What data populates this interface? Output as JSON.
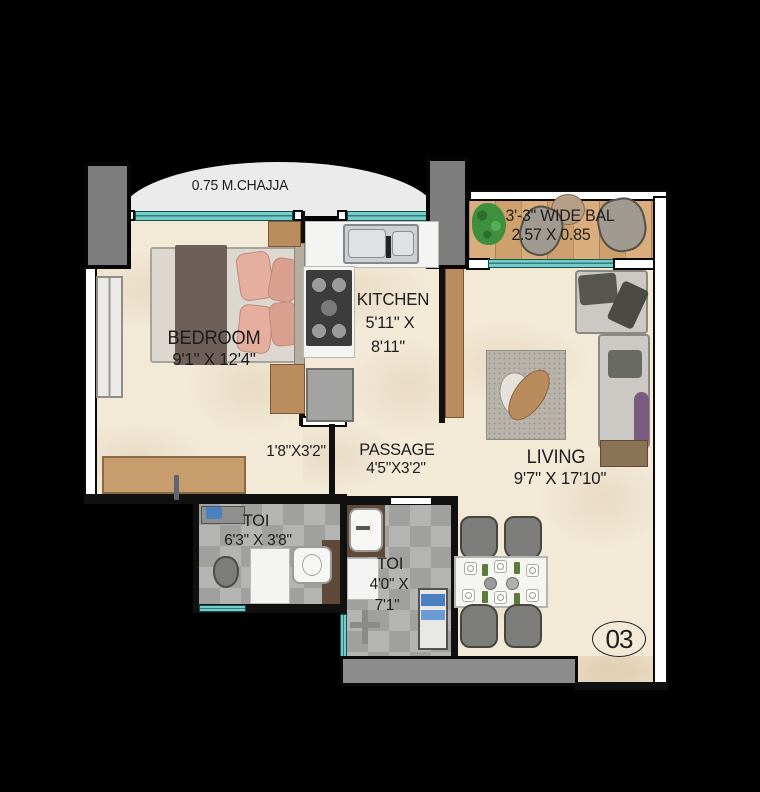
{
  "floorplan": {
    "chajja_label": "0.75 M.CHAJJA",
    "unit_number": "03",
    "rooms": {
      "balcony": {
        "name": "3'-3\" WIDE BAL",
        "dims": "2.57 X 0.85"
      },
      "bedroom": {
        "name": "BEDROOM",
        "dims": "9'1\" X 12'4\""
      },
      "kitchen": {
        "name": "KITCHEN",
        "dims_line1": "5'11\" X",
        "dims_line2": "8'11\""
      },
      "nook": {
        "dims": "1'8\"X3'2\""
      },
      "passage": {
        "name": "PASSAGE",
        "dims": "4'5\"X3'2\""
      },
      "toilet_common": {
        "name": "TOI",
        "dims": "6'3\" X 3'8\""
      },
      "toilet_attached": {
        "name": "TOI",
        "dims_line1": "4'0\" X",
        "dims_line2": "7'1\""
      },
      "living": {
        "name": "LIVING",
        "dims": "9'7\" X 17'10\""
      }
    },
    "colors": {
      "background": "#000000",
      "floor_marble": "#f2e9d7",
      "floor_wood": "#d3a876",
      "floor_tile": "#ababa9",
      "window_teal": "#74cbc8",
      "column_gray": "#7d7d7d",
      "chajja_gray": "#ebebeb",
      "text": "#1d1d1d"
    }
  }
}
